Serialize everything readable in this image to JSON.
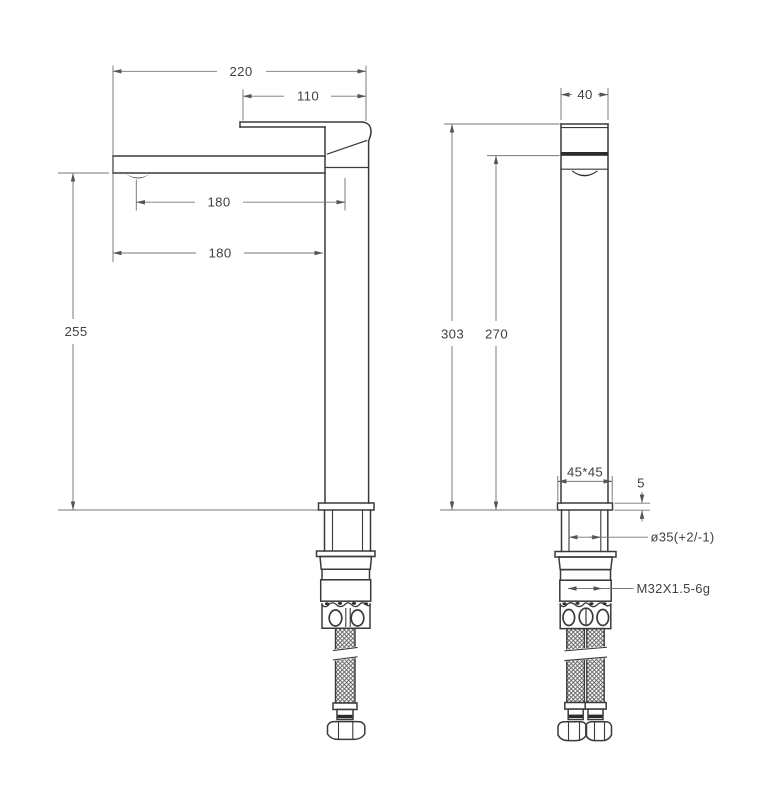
{
  "page": {
    "background": "#ffffff"
  },
  "colors": {
    "object_line": "#3a3a3a",
    "dark_fill": "#2b2b2b",
    "dimension_line": "#767676",
    "text": "#414141"
  },
  "views": {
    "side": {
      "name": "side view"
    },
    "front": {
      "name": "front view"
    }
  },
  "dims": {
    "total_width": {
      "text": "220"
    },
    "spout_top_offset": {
      "text": "110"
    },
    "aerator_to_axis": {
      "text": "180"
    },
    "spout_tip_to_body": {
      "text": "180"
    },
    "spout_height": {
      "text": "255"
    },
    "body_width": {
      "text": "40"
    },
    "total_height": {
      "text": "303"
    },
    "spout_outlet_height": {
      "text": "270"
    },
    "base_footprint": {
      "text": "45*45"
    },
    "base_plate_thickness": {
      "text": "5"
    },
    "mounting_hole": {
      "text": "ø35(+2/-1)"
    },
    "thread": {
      "text": "M32X1.5-6g"
    }
  }
}
